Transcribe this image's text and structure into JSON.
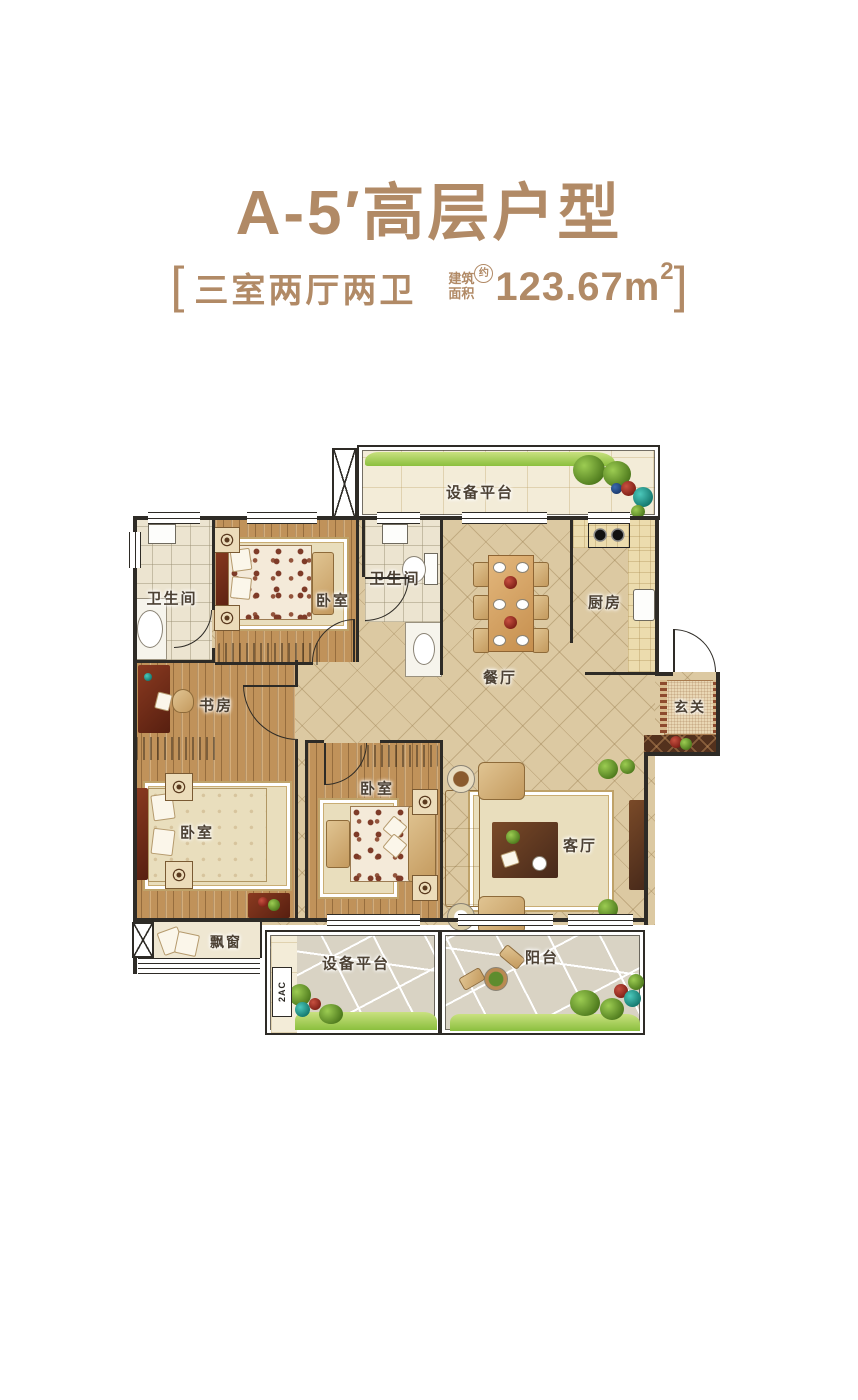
{
  "header": {
    "title": "A-5′高层户型",
    "accent_color": "#b18a66",
    "spec": {
      "open": "[",
      "rooms_text": "三室两厅两卫",
      "area_label_top": "建筑",
      "area_label_bottom": "面积",
      "area_approx": "约",
      "area_value": "123.67m",
      "area_exponent": "2",
      "close": "]"
    }
  },
  "plan": {
    "wall_color": "#2e2b26",
    "rooms": {
      "equip_top": "设备平台",
      "bath1": "卫生间",
      "bed_top": "卧室",
      "bath2": "卫生间",
      "dining": "餐厅",
      "kitchen": "厨房",
      "entry": "玄关",
      "study": "书房",
      "bed_left": "卧室",
      "bed_mid": "卧室",
      "living": "客厅",
      "bay_window": "飘窗",
      "equip_bottom": "设备平台",
      "balcony": "阳台"
    },
    "annotations": {
      "ac": "2AC"
    }
  }
}
